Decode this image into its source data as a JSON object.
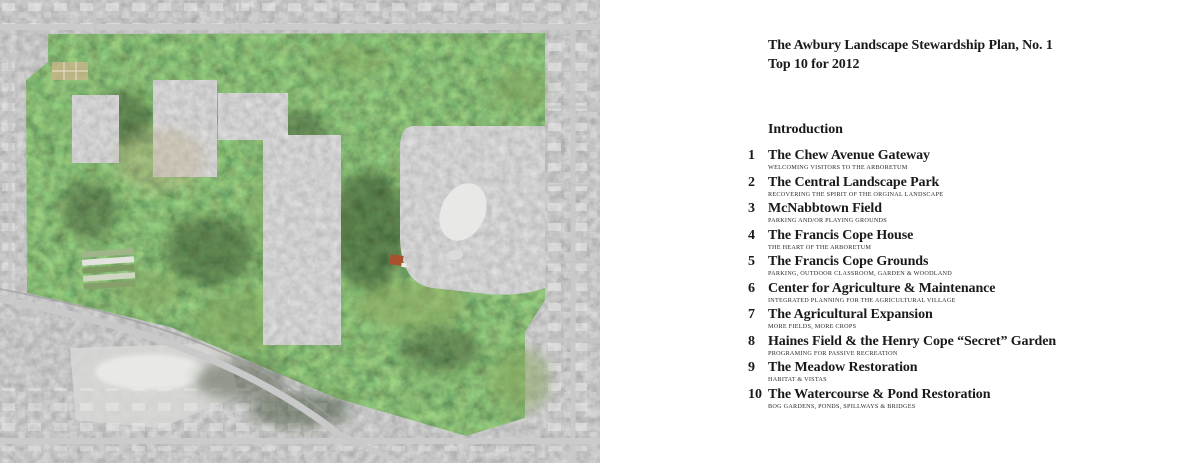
{
  "theme": {
    "paper": "#ffffff",
    "ink": "#1a1a1a",
    "subtitle-ink": "#2b2b2b"
  },
  "map": {
    "alt": "Aerial photograph of the Awbury Arboretum grounds shown in color, surrounded by a grayscale city street grid, with lighter gray rectangular overlay patches inside the grounds",
    "colors": {
      "city_gray": "#8c8c8c",
      "canopy_green": "#3f5a33",
      "field_green": "#87a35c",
      "overlay_gray": "#9a9a9a",
      "road_gray": "#c9c9c9",
      "garden_tan": "#c9b48a"
    }
  },
  "content": {
    "title_line1": "The Awbury Landscape Stewardship Plan, No. 1",
    "title_line2": "Top 10 for 2012",
    "section_heading": "Introduction",
    "items": [
      {
        "num": "1",
        "title": "The Chew Avenue Gateway",
        "subtitle": "WELCOMING VISITORS TO THE ARBORETUM"
      },
      {
        "num": "2",
        "title": "The Central Landscape Park",
        "subtitle": "RECOVERING THE SPIRIT OF THE ORGINAL LANDSCAPE"
      },
      {
        "num": "3",
        "title": "McNabbtown Field",
        "subtitle": "PARKING AND/OR PLAYING GROUNDS"
      },
      {
        "num": "4",
        "title": "The Francis Cope House",
        "subtitle": "THE HEART OF THE ARBORETUM"
      },
      {
        "num": "5",
        "title": "The Francis Cope Grounds",
        "subtitle": "PARKING, OUTDOOR CLASSROOM, GARDEN & WOODLAND"
      },
      {
        "num": "6",
        "title": "Center for Agriculture & Maintenance",
        "subtitle": "INTEGRATED PLANNING FOR THE AGRICULTURAL VILLAGE"
      },
      {
        "num": "7",
        "title": "The Agricultural Expansion",
        "subtitle": "MORE FIELDS, MORE CROPS"
      },
      {
        "num": "8",
        "title": "Haines Field & the Henry Cope “Secret” Garden",
        "subtitle": "PROGRAMING FOR PASSIVE RECREATION"
      },
      {
        "num": "9",
        "title": "The Meadow Restoration",
        "subtitle": "HABITAT & VISTAS"
      },
      {
        "num": "10",
        "title": "The Watercourse & Pond Restoration",
        "subtitle": "BOG GARDENS, PONDS, SPILLWAYS & BRIDGES"
      }
    ]
  }
}
